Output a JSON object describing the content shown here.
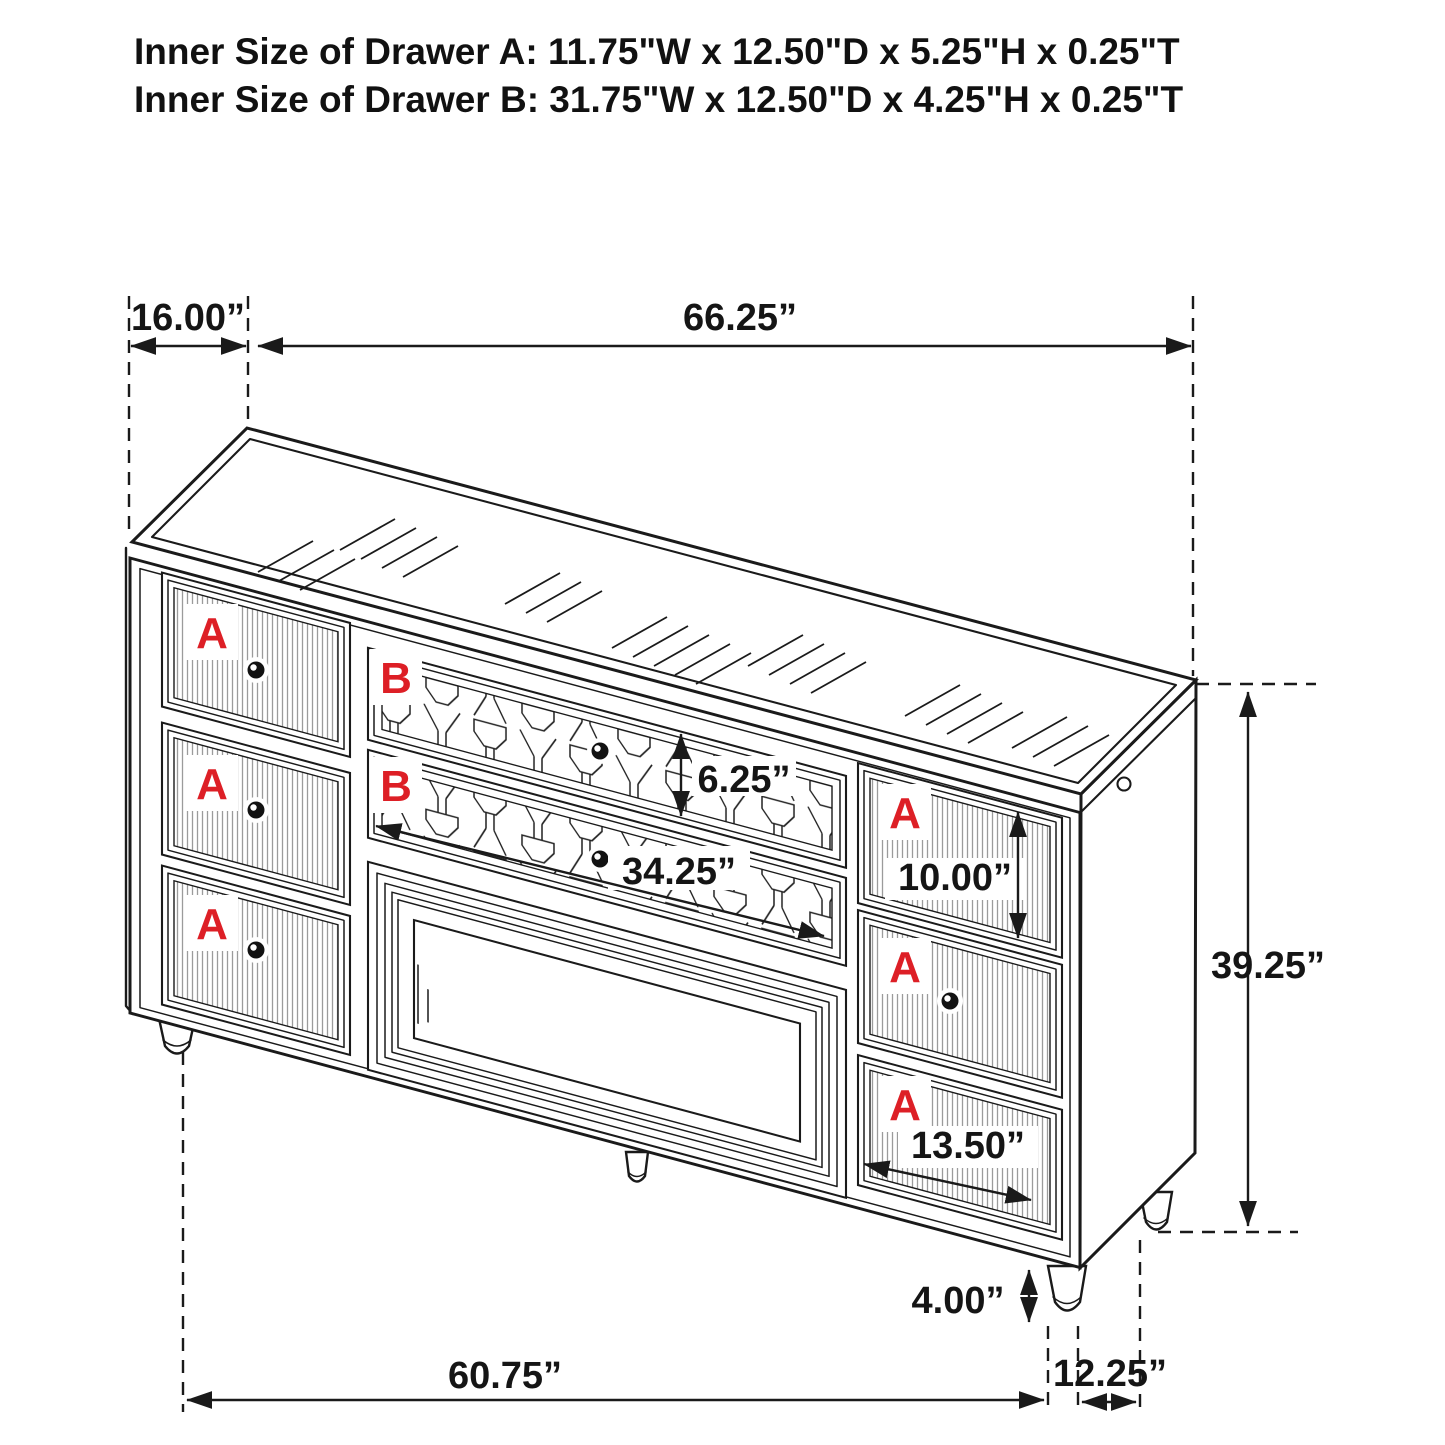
{
  "title": {
    "line1": "Inner Size of Drawer A: 11.75\"W x 12.50\"D x 5.25\"H x 0.25\"T",
    "line2": "Inner Size of Drawer B: 31.75\"W x 12.50\"D x 4.25\"H x 0.25\"T"
  },
  "drawer_labels": {
    "left": [
      "A",
      "A",
      "A"
    ],
    "middle": [
      "B",
      "B"
    ],
    "right": [
      "A",
      "A",
      "A"
    ]
  },
  "dimensions": {
    "top_depth": "16.00”",
    "top_width": "66.25”",
    "overall_height": "39.25”",
    "drawer_b_front_height": "6.25”",
    "drawer_b_front_width": "34.25”",
    "right_drawer_height": "10.00”",
    "right_drawer_width": "13.50”",
    "leg_height": "4.00”",
    "front_width_between_legs": "60.75”",
    "side_depth_between_legs": "12.25”"
  },
  "colors": {
    "line": "#1a1a1a",
    "label_red": "#dd1f26",
    "background": "#ffffff"
  }
}
